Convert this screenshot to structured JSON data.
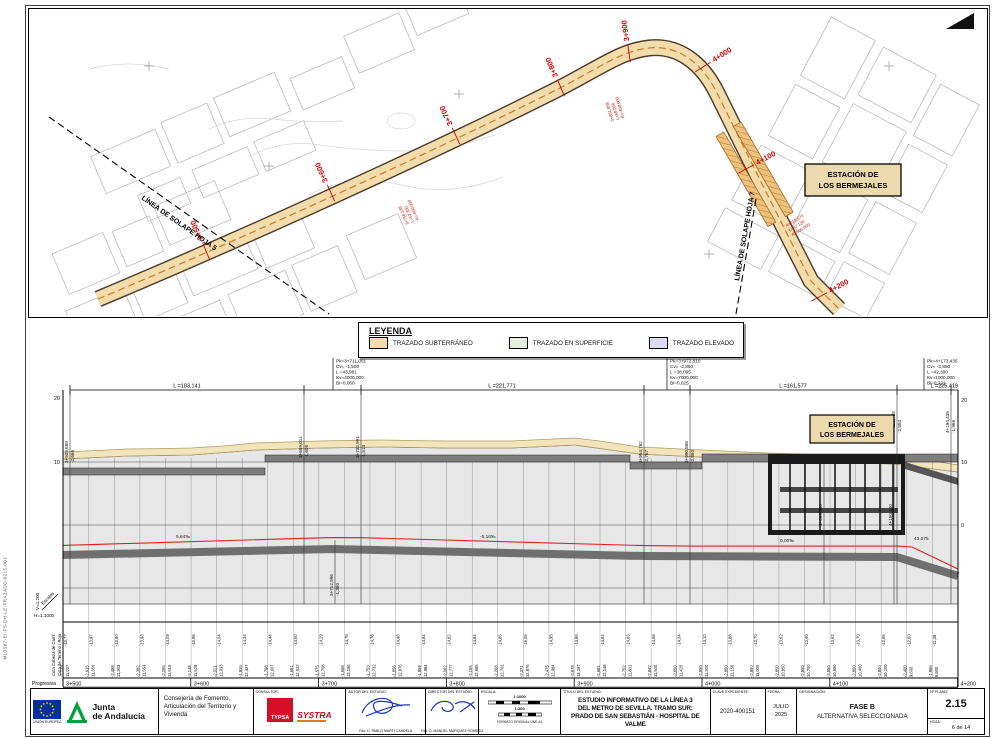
{
  "sheet": {
    "file_code": "ML3S67-EI-PS-DH-LE-TRAZADO-0215-001"
  },
  "map": {
    "station_box": [
      "ESTACIÓN DE",
      "LOS BERMEJALES"
    ],
    "overlap_line_left": "LÍNEA DE SOLAPE HOJA 5",
    "overlap_line_right": "LÍNEA DE SOLAPE HOJA 7",
    "chainages": [
      "3+500",
      "3+600",
      "3+700",
      "3+800",
      "3+900",
      "4+000",
      "4+100",
      "4+200"
    ],
    "curve_notes": [
      {
        "l1": "3+756,138",
        "l2": "L=52,350",
        "l3": "R=-650,000"
      },
      {
        "l1": "3+891,858",
        "l2": "L=68,056",
        "l3": "R=-450,000"
      },
      {
        "l1": "4+019,574",
        "l2": "L=47,120",
        "l3": "R=500,000"
      }
    ]
  },
  "legend": {
    "title": "LEYENDA",
    "items": [
      {
        "label": "TRAZADO SUBTERRÁNEO",
        "color": "#f3ddad"
      },
      {
        "label": "TRAZADO EN SUPERFICIE",
        "color": "#e2f2dd"
      },
      {
        "label": "TRAZADO ELEVADO",
        "color": "#dcdcf2"
      }
    ]
  },
  "profile": {
    "station_box": [
      "ESTACIÓN DE",
      "LOS BERMEJALES"
    ],
    "axis_left": [
      "20",
      "10"
    ],
    "axis_right": [
      "20",
      "10",
      "0"
    ],
    "scales": {
      "v": "V=1:200",
      "label": "Escalas",
      "h": "H=1:1000"
    },
    "span_labels": [
      "L =183,141",
      "L =221,771",
      "L =161,577",
      "L =225,419"
    ],
    "grades": [
      "5,64‰",
      "-5,16‰",
      "0,00‰",
      "43,075"
    ],
    "pk_blocks": [
      {
        "lines": [
          "Pk=3+711,001",
          "Cv= -1,500",
          "L =43,981",
          "Kv=4000,000",
          "Bi=0,060"
        ]
      },
      {
        "lines": [
          "Pk=3+972,810",
          "Cv= -2,850",
          "L =38,095",
          "Kv=7000,000",
          "Bi=0,025"
        ]
      },
      {
        "lines": [
          "Pk=4+173,435",
          "Cv= -2,850",
          "L =42,300",
          "Kv=1000,000",
          "Bi=0,221"
        ]
      }
    ],
    "markers": [
      {
        "ch": "3+505,669",
        "v": "-2,666"
      },
      {
        "ch": "3+689,011",
        "v": "-1,608"
      },
      {
        "ch": "3+712,996",
        "v": "-1,380"
      },
      {
        "ch": "3+732,991",
        "v": "-1,513"
      },
      {
        "ch": "3+954,762",
        "v": "-2,767"
      },
      {
        "ch": "3+990,858",
        "v": "-2,850"
      },
      {
        "ch": "4+095,300",
        "v": ""
      },
      {
        "ch": "4+150,300",
        "v": ""
      },
      {
        "ch": "4+152,435",
        "v": "-2,850"
      },
      {
        "ch": "4+194,435",
        "v": "-1,966"
      }
    ],
    "table": {
      "row_labels": [
        "Cota Cabeza de Carril",
        "Cota de Terreno / Roja",
        "Progresiva"
      ],
      "columns": [
        {
          "c": "-13,77",
          "t": "11,037",
          "r": "-2,739"
        },
        {
          "c": "-13,97",
          "t": "11,356",
          "r": "-2,615"
        },
        {
          "c": "-13,80",
          "t": "11,303",
          "r": "-2,488"
        },
        {
          "c": "-13,93",
          "t": "11,554",
          "r": "-2,382"
        },
        {
          "c": "-14,09",
          "t": "11,615",
          "r": "-2,265"
        },
        {
          "c": "-13,98",
          "t": "11,629",
          "r": "-2,148"
        },
        {
          "c": "-14,04",
          "t": "12,013",
          "r": "-2,021"
        },
        {
          "c": "-14,34",
          "t": "12,427",
          "r": "-1,915"
        },
        {
          "c": "-14,44",
          "t": "12,607",
          "r": "-1,798"
        },
        {
          "c": "-14,50",
          "t": "12,622",
          "r": "-1,681"
        },
        {
          "c": "-14,29",
          "t": "12,708",
          "r": "-1,575"
        },
        {
          "c": "-14,75",
          "t": "13,156",
          "r": "-1,568"
        },
        {
          "c": "-14,76",
          "t": "12,732",
          "r": "-1,753"
        },
        {
          "c": "-14,48",
          "t": "12,976",
          "r": "-1,856"
        },
        {
          "c": "-14,84",
          "t": "12,984",
          "r": "-1,959"
        },
        {
          "c": "-14,82",
          "t": "12,777",
          "r": "-2,062"
        },
        {
          "c": "-14,84",
          "t": "12,685",
          "r": "-2,165"
        },
        {
          "c": "-14,85",
          "t": "12,761",
          "r": "-2,268"
        },
        {
          "c": "-15,05",
          "t": "12,976",
          "r": "-2,371"
        },
        {
          "c": "-14,95",
          "t": "12,984",
          "r": "-2,475"
        },
        {
          "c": "-14,86",
          "t": "13,267",
          "r": "-2,578"
        },
        {
          "c": "-14,84",
          "t": "12,148",
          "r": "-2,681"
        },
        {
          "c": "-14,83",
          "t": "11,801",
          "r": "-2,752"
        },
        {
          "c": "-14,58",
          "t": "11,500",
          "r": "-2,842"
        },
        {
          "c": "-14,34",
          "t": "11,420",
          "r": "-2,850"
        },
        {
          "c": "-14,10",
          "t": "11,300",
          "r": "-2,850"
        },
        {
          "c": "-13,88",
          "t": "11,150",
          "r": "-2,850"
        },
        {
          "c": "-13,70",
          "t": "11,000",
          "r": "-2,850"
        },
        {
          "c": "-13,62",
          "t": "10,850",
          "r": "-2,850"
        },
        {
          "c": "-13,60",
          "t": "10,700",
          "r": "-2,850"
        },
        {
          "c": "-13,62",
          "t": "10,550",
          "r": "-2,850"
        },
        {
          "c": "-13,70",
          "t": "10,400",
          "r": "-2,850"
        },
        {
          "c": "-13,85",
          "t": "10,200",
          "r": "-2,800"
        },
        {
          "c": "-12,60",
          "t": "9,600",
          "r": "-2,400"
        },
        {
          "c": "-11,38",
          "t": "8,900",
          "r": "-1,966"
        }
      ],
      "progresivas": [
        "3+500",
        "3+600",
        "3+700",
        "3+800",
        "3+900",
        "4+000",
        "4+100",
        "4+200"
      ]
    }
  },
  "titleblock": {
    "eu": {
      "caption": "UNIÓN EUROPEA"
    },
    "junta": {
      "name1": "Junta",
      "name2": "de Andalucía"
    },
    "consejeria": "Consejería de Fomento, Articulación del Territorio y Vivienda",
    "consultor": {
      "header": "CONSULTOR:",
      "typsa": "TYPSA",
      "systra": "SYSTRA"
    },
    "autor": {
      "header": "AUTOR DEL ESTUDIO:",
      "firma": "Fdo: D. PABLO MARTÍ CANDELA"
    },
    "director": {
      "header": "DIRECTOR DEL ESTUDIO:",
      "firma": "Fdo: D. MANUEL MÁRQUEZ ROMERO"
    },
    "escala": {
      "header": "ESCALA:",
      "s1": "1:1000",
      "s2": "1:200",
      "formato": "FORMATO ORIGINAL UNE-A1"
    },
    "titulo": {
      "header": "TÍTULO DEL ESTUDIO:",
      "lines": [
        "ESTUDIO INFORMATIVO DE LA LÍNEA 3",
        "DEL METRO DE SEVILLA. TRAMO SUR:",
        "PRADO DE SAN SEBASTIÁN - HOSPITAL DE VALME"
      ]
    },
    "clave": {
      "header": "CLAVE EXPEDIENTE:",
      "value": "2020-400151"
    },
    "fecha": {
      "header": "FECHA:",
      "l1": "JULIO",
      "l2": "2025"
    },
    "designacion": {
      "header": "DESIGNACIÓN:",
      "l1": "FASE B",
      "l2": "ALTERNATIVA SELECCIONADA"
    },
    "plano": {
      "header": "Nº PLANO:",
      "value": "2.15",
      "hoja_label": "HOJA:",
      "hoja": "6 de 14"
    }
  }
}
